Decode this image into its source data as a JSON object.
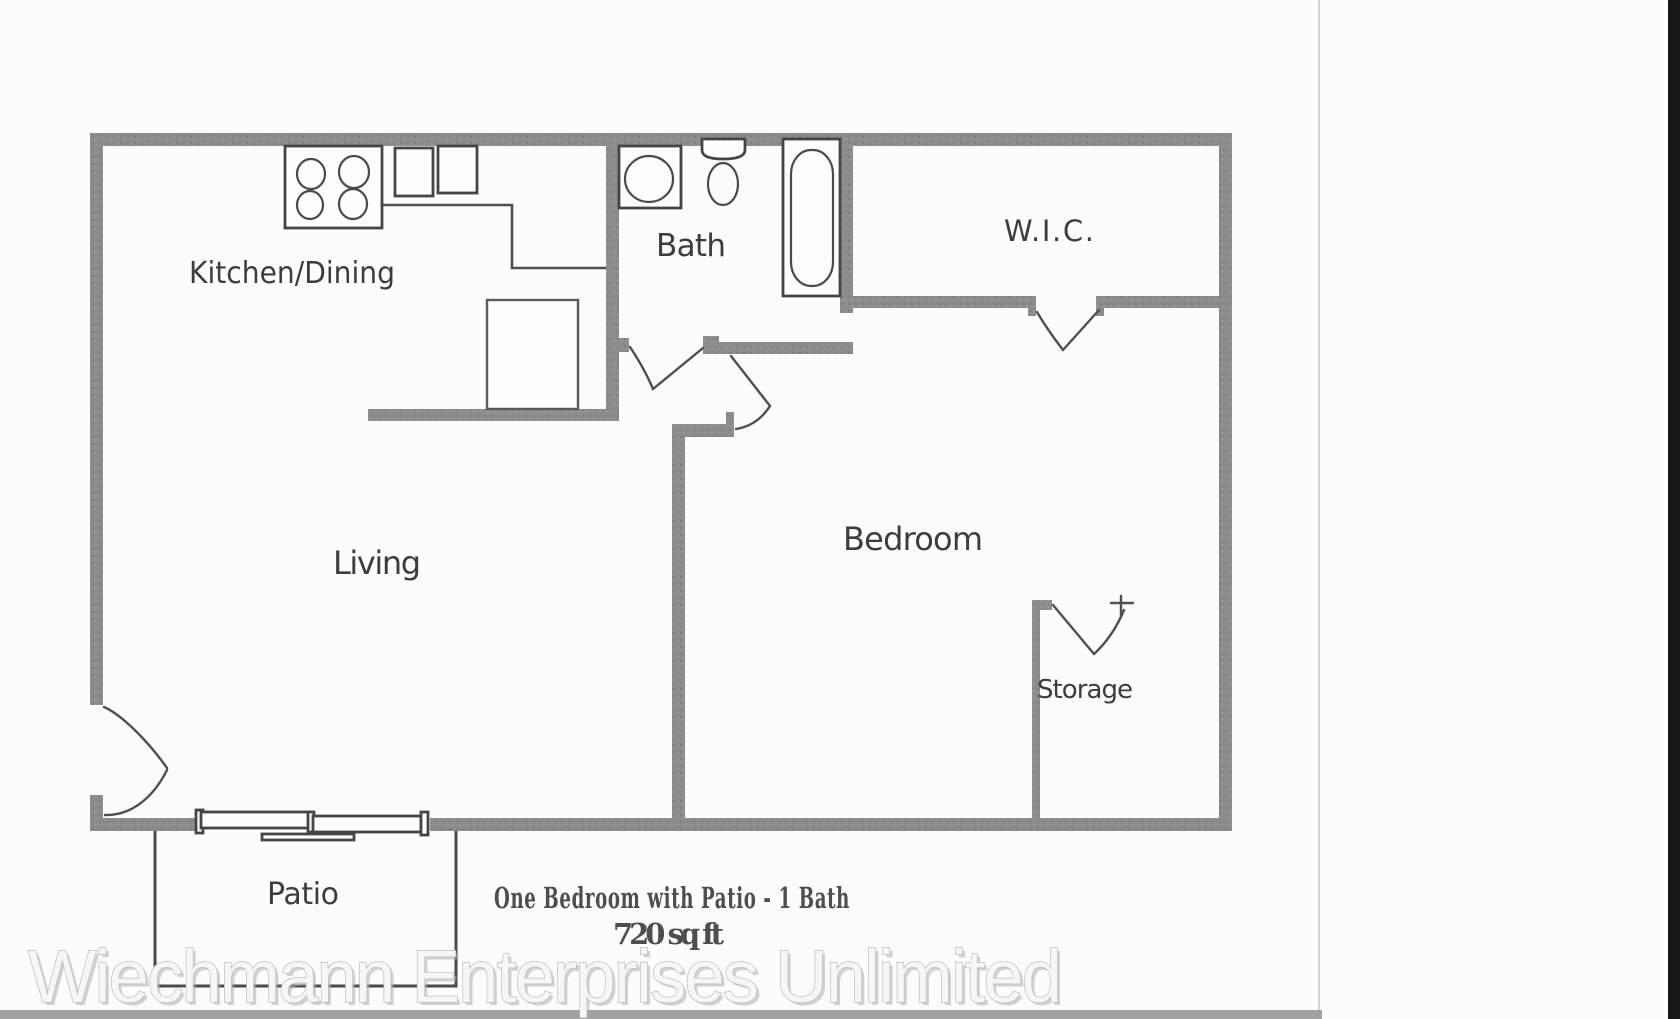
{
  "page": {
    "background_color": "#fcfcfc",
    "scan_edge_color": "#c9c9c9",
    "bottom_shadow_color": "#909090",
    "right_strip_color": "#171717",
    "wall_color": "#8d8d8d",
    "line_color": "#4f4f4f"
  },
  "floor_plan": {
    "rooms": {
      "kitchen_dining": {
        "label": "Kitchen/Dining"
      },
      "bath": {
        "label": "Bath"
      },
      "wic": {
        "label": "W.I.C."
      },
      "living": {
        "label": "Living"
      },
      "bedroom": {
        "label": "Bedroom"
      },
      "storage": {
        "label": "Storage"
      },
      "patio": {
        "label": "Patio"
      }
    },
    "fixtures": [
      "stove-4-burners",
      "kitchen-double-sink",
      "kitchen-counter",
      "pantry-closet",
      "bathroom-sink",
      "toilet",
      "bathtub",
      "entry-door-swing",
      "bath-door-swing",
      "bedroom-door-swing",
      "wic-door-swing",
      "storage-door-swing",
      "sliding-patio-door",
      "patio-outline"
    ]
  },
  "caption": {
    "line1": "One Bedroom with Patio - 1 Bath",
    "line2": "720 sq ft"
  },
  "watermark": {
    "text": "Wiechmann Enterprises Unlimited"
  }
}
